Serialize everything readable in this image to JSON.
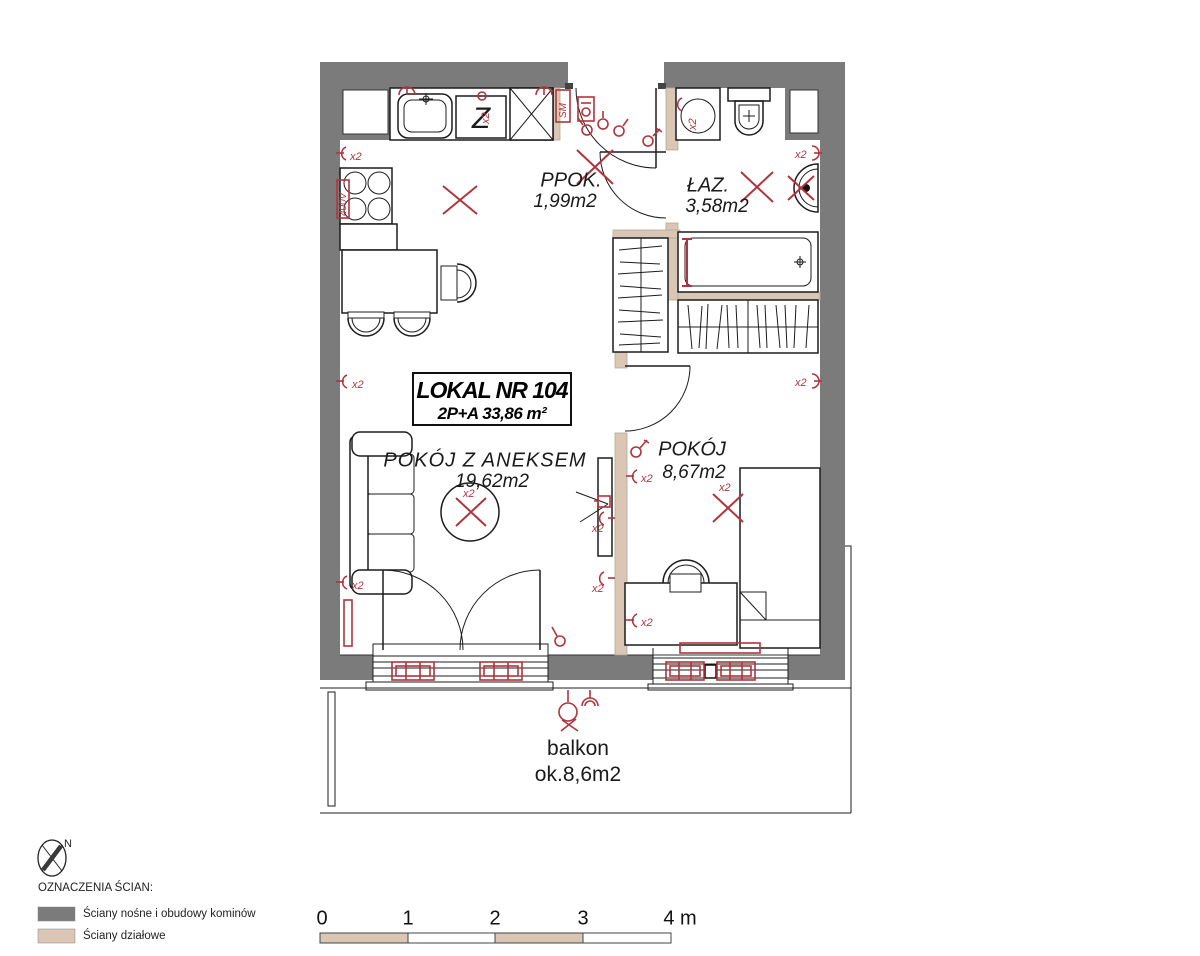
{
  "title_box": {
    "line1": "LOKAL NR 104",
    "line2": "2P+A   33,86 m²"
  },
  "rooms": {
    "ppok": {
      "name": "PPOK.",
      "area": "1,99m2"
    },
    "laz": {
      "name": "ŁAZ.",
      "area": "3,58m2"
    },
    "living": {
      "name": "POKÓJ Z ANEKSEM",
      "area": "19,62m2"
    },
    "bedroom": {
      "name": "POKÓJ",
      "area": "8,67m2"
    },
    "balcony": {
      "name": "balkon",
      "area": "ok.8,6m2"
    }
  },
  "annotations": {
    "x2": "x2",
    "sm": "SM",
    "z": "Z",
    "power": "400V",
    "north": "N"
  },
  "legend": {
    "heading": "OZNACZENIA ŚCIAN:",
    "items": [
      {
        "label": "Ściany nośne i obudowy kominów",
        "color": "#7b7b7b"
      },
      {
        "label": "Ściany działowe",
        "color": "#d9c6b5"
      }
    ]
  },
  "scale_bar": {
    "ticks": [
      "0",
      "1",
      "2",
      "3",
      "4 m"
    ]
  },
  "colors": {
    "load_bearing": "#7b7b7b",
    "partition": "#d9c6b5",
    "symbols": "#b0343c",
    "lines": "#1c1c1c"
  }
}
